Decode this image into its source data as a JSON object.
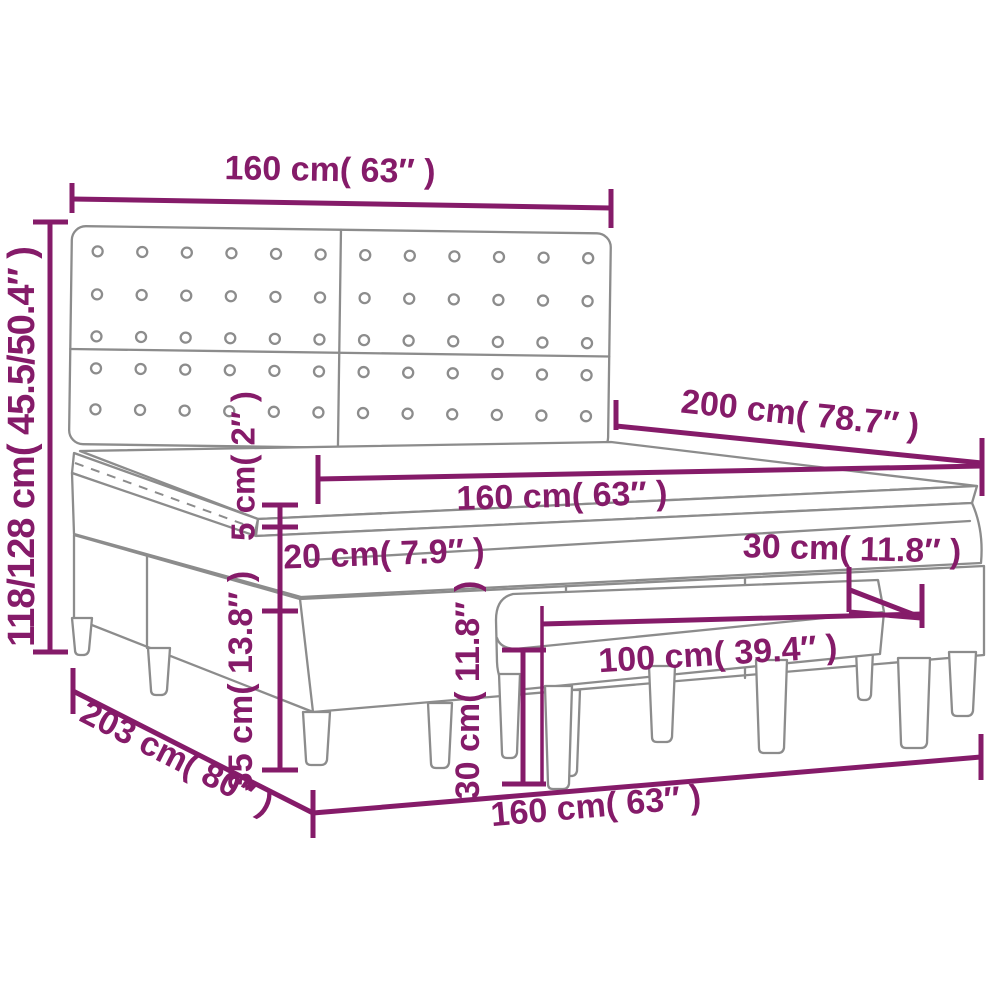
{
  "diagram": {
    "title_semantic": "box-spring-bed-with-bench-dimension-diagram",
    "accent_color": "#851b69",
    "line_color": "#8c8c8c",
    "background_color": "#ffffff",
    "labels": {
      "headboard_width_top": "160 cm( 63″ )",
      "overall_height_left": "118/128 cm( 45.5/50.4″ )",
      "mattress_length": "200 cm( 78.7″ )",
      "mattress_width_middle": "160 cm( 63″ )",
      "topper_height": "5 cm( 2″ )",
      "mattress_height": "20 cm( 7.9″ )",
      "base_height": "35 cm( 13.8″ )",
      "bench_depth": "30 cm( 11.8″ )",
      "bench_width": "100 cm( 39.4″ )",
      "bench_height": "30 cm( 11.8″ )",
      "bed_depth_bottom": "203 cm( 80″ )",
      "bed_width_bottom": "160 cm( 63″ )"
    }
  }
}
